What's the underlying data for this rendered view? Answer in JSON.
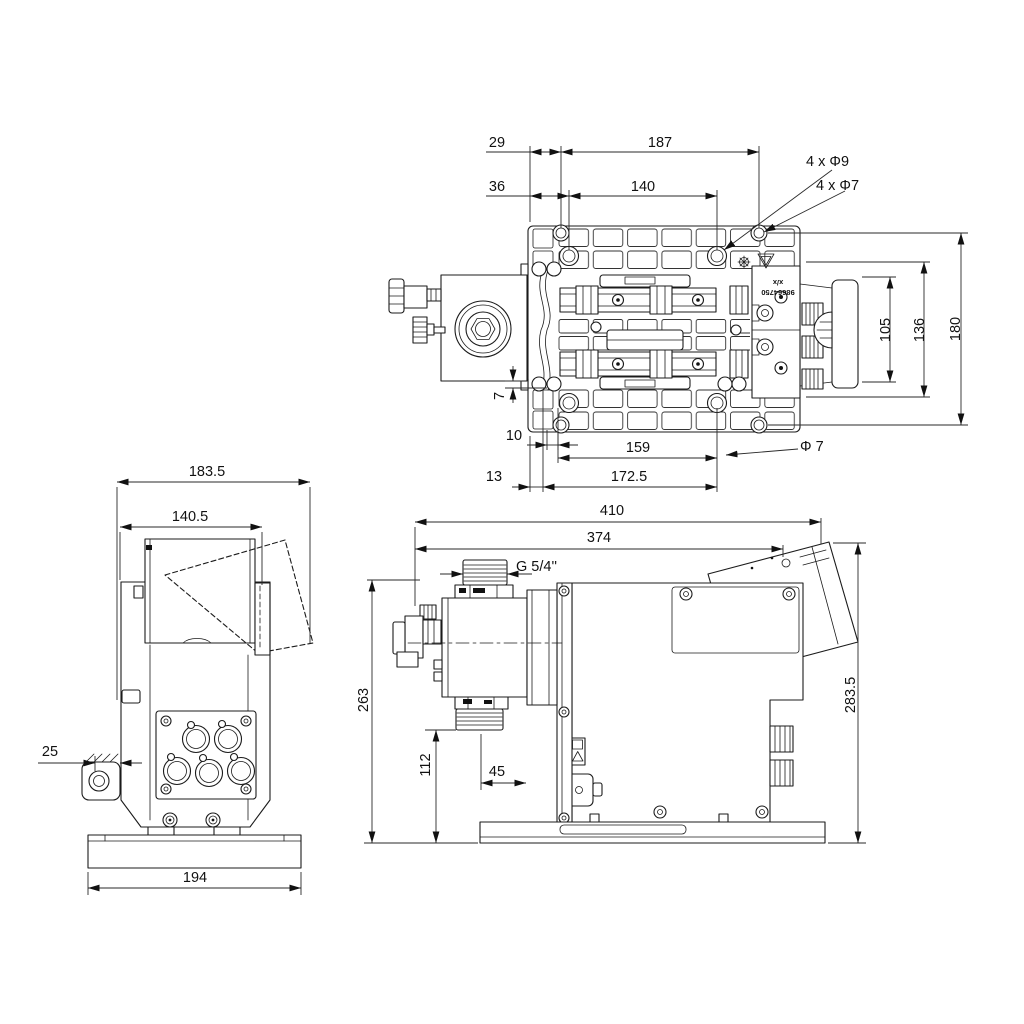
{
  "drawing": {
    "top_view": {
      "dim_29": "29",
      "dim_187": "187",
      "dim_36": "36",
      "dim_140": "140",
      "holes_label_1": "4 x Φ9",
      "holes_label_2": "4 x Φ7",
      "dim_105": "105",
      "dim_136": "136",
      "dim_180": "180",
      "dim_7": "7",
      "dim_10": "10",
      "dim_159": "159",
      "hole_dia_label": "Φ 7",
      "dim_13": "13",
      "dim_172_5": "172.5",
      "part_label_top": "x/x",
      "part_label_bottom": "98664750"
    },
    "end_view": {
      "dim_183_5": "183.5",
      "dim_140_5": "140.5",
      "dim_25": "25",
      "dim_194": "194"
    },
    "side_view": {
      "dim_410": "410",
      "dim_374": "374",
      "thread_label": "G 5/4''",
      "dim_263": "263",
      "dim_112": "112",
      "dim_45": "45",
      "dim_283_5": "283.5"
    },
    "colors": {
      "line": "#1b1b1b",
      "background": "#ffffff"
    }
  }
}
